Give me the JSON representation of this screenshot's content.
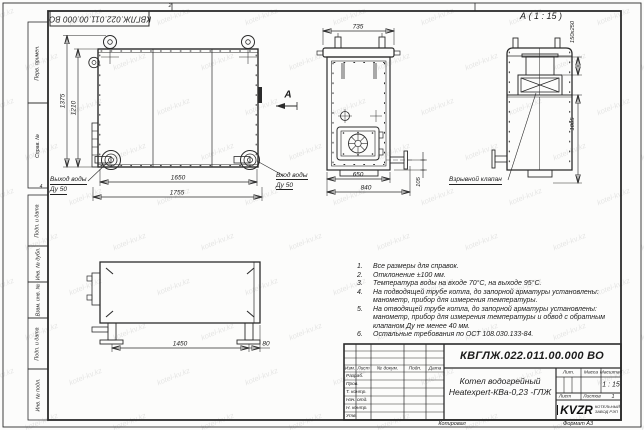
{
  "watermark": {
    "text": "kotel-kv.kz"
  },
  "sheet": {
    "doc_number_top": "КВГЛЖ.022.011.00.000 ВО",
    "zone_top": "2",
    "zone_left": "4",
    "margin_labels": [
      "Перв. примен.",
      "Справ. №",
      "Подп. и дата",
      "Инв. № дубл.",
      "Взам. инв. №",
      "Подп. и дата",
      "Инв. № подл."
    ],
    "footer": {
      "copied_by": "Копировал",
      "format": "Формат А3"
    }
  },
  "front_view": {
    "dim_height_outer": "1375",
    "dim_height_inner": "1210",
    "dim_width_inner": "1650",
    "dim_width_outer": "1755",
    "outlet_label": "Выход воды",
    "outlet_size": "Ду 50",
    "inlet_label": "Вход воды",
    "inlet_size": "Ду 50",
    "section_letter": "А"
  },
  "side_view": {
    "dim_top": "735",
    "dim_inner": "650",
    "dim_outer": "840",
    "dim_pipe": "105"
  },
  "detail_view": {
    "title": "А ( 1 : 15 )",
    "dim_valve": "150x250",
    "dim_height": "1005",
    "valve_label": "Взрывной клапан"
  },
  "top_view": {
    "dim_width": "1450",
    "dim_offset": "80"
  },
  "notes": [
    {
      "n": "1.",
      "text": "Все размеры для справок."
    },
    {
      "n": "2.",
      "text": "Отклонение ±100 мм."
    },
    {
      "n": "3.",
      "text": "Температура воды на входе 70°С, на выходе 95°С."
    },
    {
      "n": "4.",
      "text": "На подводящей трубе котла, до запорной арматуры установлены: манометр, прибор для измерения температуры."
    },
    {
      "n": "5.",
      "text": "На отводящей трубе котла, до запорной арматуры установлены: манометр, прибор для измерения температуры и обвод с обратным клапаном Ду не менее 40 мм."
    },
    {
      "n": "6.",
      "text": "Остальные требования по ОСТ 108.030.133-84."
    }
  ],
  "title_block": {
    "doc_number": "КВГЛЖ.022.011.00.000 ВО",
    "name_line1": "Котел водогрейный",
    "name_line2": "Heatexpert-КВа-0,23 -ГЛЖ",
    "columns": [
      "Изм.",
      "Лист",
      "№ докум.",
      "Подп.",
      "Дата"
    ],
    "rows": [
      "Разраб.",
      "Пров.",
      "Т. контр.",
      "Нач. отд.",
      "Н. контр.",
      "Утв."
    ],
    "lit_label": "Лит.",
    "mass_label": "Масса",
    "scale_label": "Масштаб",
    "scale_value": "1 : 15",
    "sheet_label": "Лист",
    "sheets_label": "Листов",
    "sheets_value": "1",
    "logo_text": "KVZR",
    "logo_caption_line1": "КОТЕЛЬНЫЙ",
    "logo_caption_line2": "ЗАВОД РЭП"
  }
}
